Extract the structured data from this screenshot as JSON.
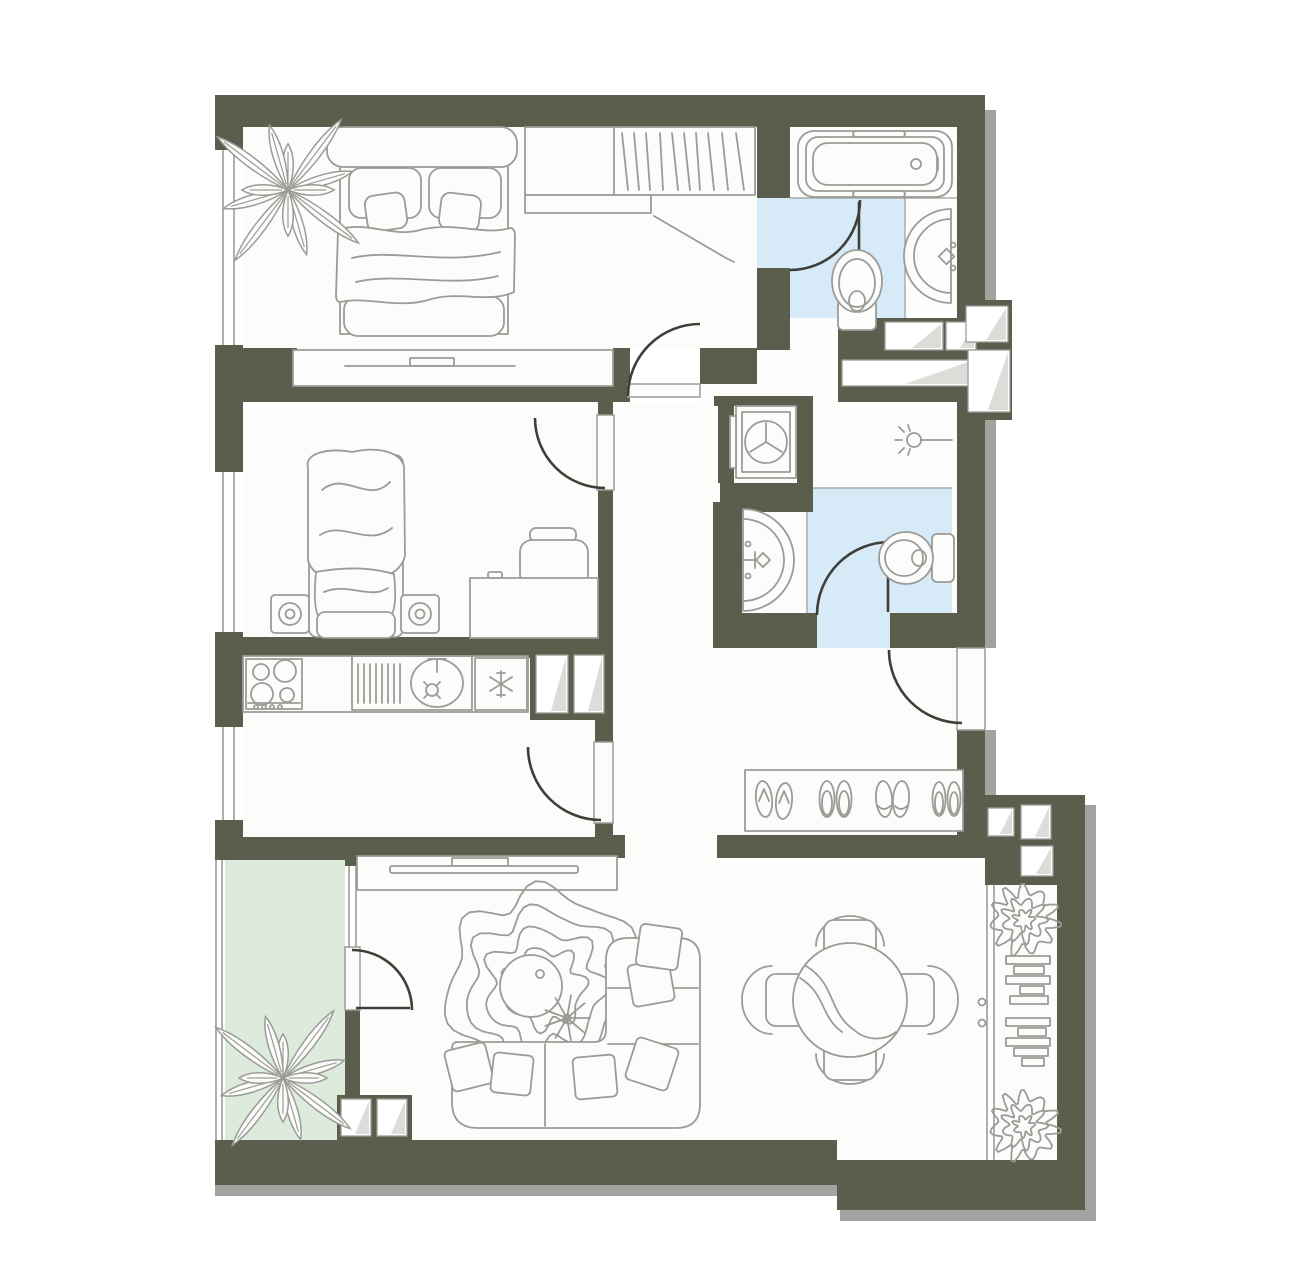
{
  "colors": {
    "wall": "#5c5e4d",
    "floor": "#fcfcfa",
    "wet": "#d7eaf8",
    "balcony": "#dcebdc",
    "line": "#9b9b98",
    "door": "#3e3e3a",
    "fold": "#dcdcd8",
    "shadow": "#a2a29f",
    "bg": "#ffffff"
  },
  "floor_plan": {
    "type": "apartment-top-view",
    "rooms": [
      {
        "name": "bedroom-1",
        "floor": "standard",
        "contents": [
          "double-bed",
          "pillows",
          "cushions",
          "blanket",
          "potted-plant",
          "wardrobe-with-hanging-clothes",
          "dresser-with-tv"
        ]
      },
      {
        "name": "bathroom-1",
        "floor": "wet-blue",
        "contents": [
          "bathtub",
          "toilet",
          "washbasin"
        ]
      },
      {
        "name": "bedroom-2",
        "floor": "standard",
        "contents": [
          "single-bed",
          "speaker-left",
          "speaker-right",
          "desk",
          "chair"
        ]
      },
      {
        "name": "kitchen",
        "floor": "standard",
        "contents": [
          "countertop",
          "stove-4-burners",
          "sink-with-drainer",
          "fridge-snowflake"
        ]
      },
      {
        "name": "laundry-niche",
        "floor": "standard",
        "contents": [
          "washing-machine"
        ]
      },
      {
        "name": "shower-room",
        "floor": "standard",
        "contents": [
          "ceiling-light"
        ]
      },
      {
        "name": "bathroom-2",
        "floor": "wet-blue",
        "contents": [
          "washbasin",
          "toilet"
        ]
      },
      {
        "name": "corridor",
        "floor": "standard",
        "contents": []
      },
      {
        "name": "hallway",
        "floor": "standard",
        "contents": [
          "shoe-mat",
          "flip-flops-pair",
          "slippers-pair",
          "slippers-pair",
          "slippers-pair"
        ]
      },
      {
        "name": "living-dining-room",
        "floor": "standard",
        "contents": [
          "tv-console",
          "tv",
          "wavy-rug",
          "round-coffee-table",
          "small-plant",
          "corner-sofa",
          "pillows",
          "round-dining-table",
          "dining-chairs-4"
        ]
      },
      {
        "name": "balcony-left",
        "floor": "green",
        "contents": [
          "potted-plant"
        ]
      },
      {
        "name": "balcony-right",
        "floor": "standard",
        "contents": [
          "bush-plant-top",
          "shelf-stack-top",
          "shelf-stack-bottom",
          "bush-plant-bottom"
        ]
      }
    ],
    "doors": [
      {
        "name": "door-bedroom-1",
        "swing": "into-bedroom-1"
      },
      {
        "name": "door-bedroom-2",
        "swing": "into-bedroom-2"
      },
      {
        "name": "door-kitchen",
        "swing": "into-kitchen"
      },
      {
        "name": "door-bathroom-1",
        "swing": "into-bathroom-1"
      },
      {
        "name": "door-bathroom-2",
        "swing": "into-bathroom-2"
      },
      {
        "name": "door-balcony-left",
        "swing": "into-living-room"
      },
      {
        "name": "door-entrance",
        "swing": "into-hallway"
      }
    ],
    "windows": [
      "window-bedroom-1",
      "window-bedroom-2",
      "window-kitchen",
      "balcony-left-glazing",
      "balcony-door-window",
      "glass-partition-right"
    ],
    "vent_shafts": 12
  }
}
